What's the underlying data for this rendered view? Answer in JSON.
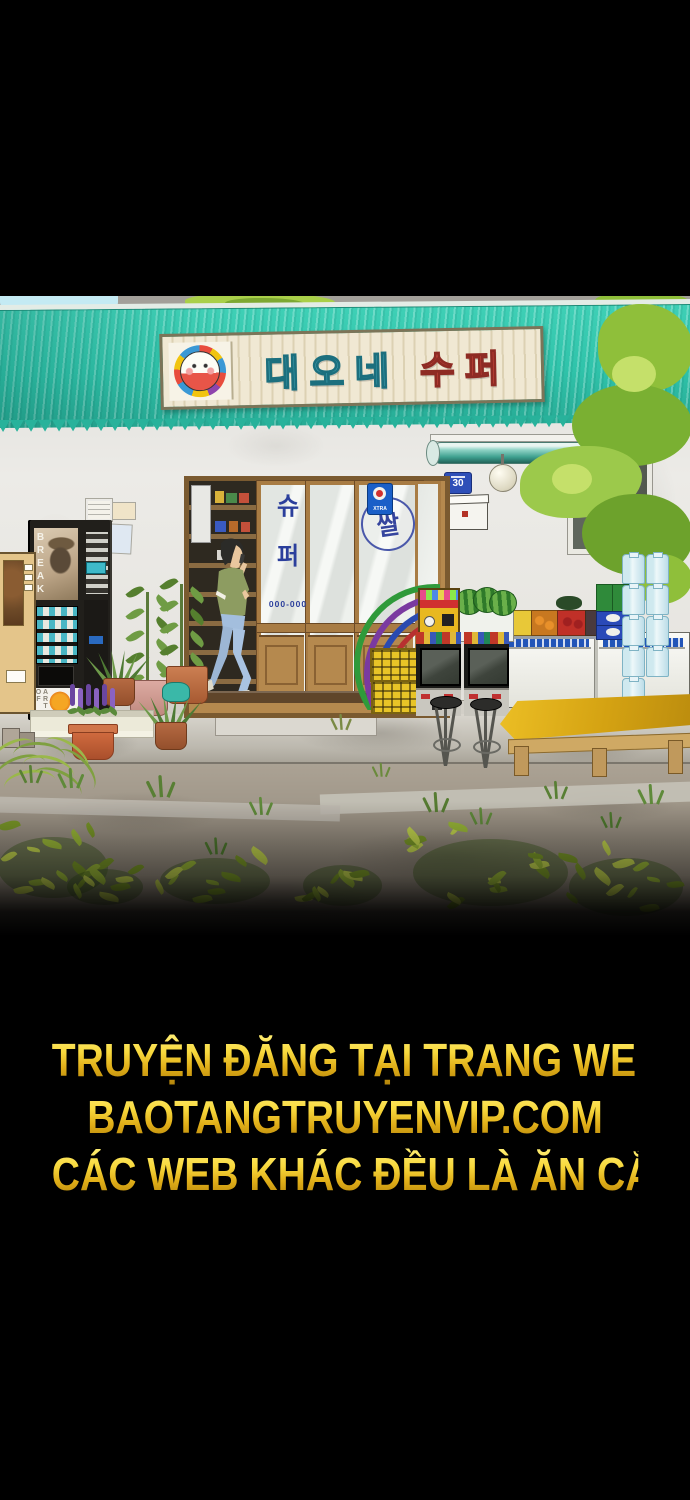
{
  "panel": {
    "store_sign": {
      "name_part_teal": "대오네",
      "name_part_red": "수퍼"
    },
    "address_plaque": {
      "number": "30"
    },
    "storefront": {
      "door_glass_vertical_text": [
        "슈",
        "퍼"
      ],
      "door_phone_number": "000-000",
      "rice_sign_text": "쌀",
      "door_sticker_text": "XTRA"
    },
    "coffee_machine": {
      "poster_text": "BREAK",
      "cup_panel_text": "ART OF"
    }
  },
  "watermark": {
    "line1": "TRUYỆN ĐĂNG TẠI TRANG WEB",
    "line2": "BAOTANGTRUYENVIP.COM",
    "line3": "CÁC WEB KHÁC ĐỀU LÀ ĂN CẮP"
  },
  "colors": {
    "roof_teal": "#2fc3aa",
    "sign_text_teal": "#52b9c8",
    "sign_text_red": "#e05045",
    "watermark_gold": "#f2c52c",
    "background": "#000000"
  }
}
